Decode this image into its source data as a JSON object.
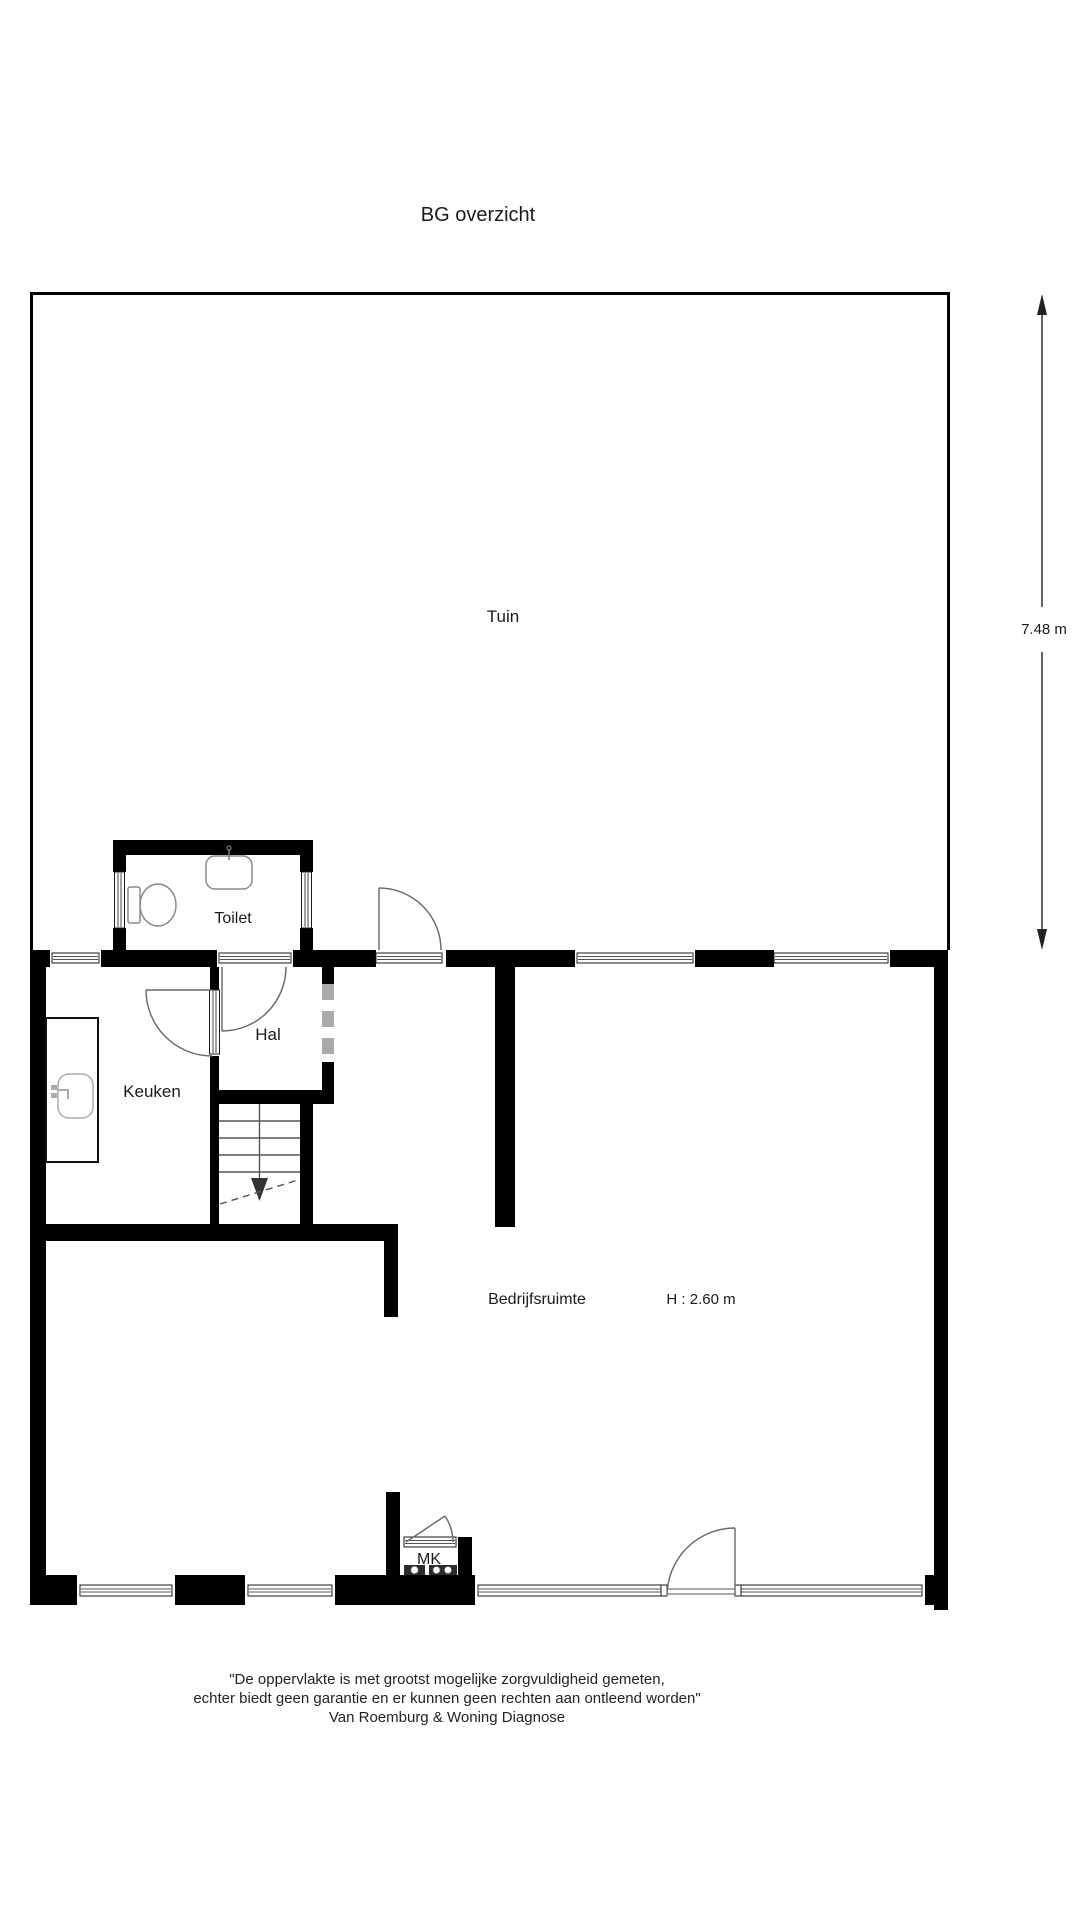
{
  "title": "BG overzicht",
  "plan": {
    "rooms": {
      "tuin": "Tuin",
      "toilet": "Toilet",
      "hal": "Hal",
      "keuken": "Keuken",
      "bedrijfsruimte": "Bedrijfsruimte",
      "mk": "MK"
    },
    "dimension": "7.48 m",
    "ceiling_height": "H : 2.60 m"
  },
  "footer": {
    "line1": "\"De oppervlakte is met grootst mogelijke zorgvuldigheid gemeten,",
    "line2": "echter biedt geen garantie en er kunnen geen rechten aan ontleend worden\"",
    "line3": "Van Roemburg & Woning Diagnose"
  },
  "colors": {
    "wall": "#000000",
    "background": "#ffffff",
    "door_line": "#666666",
    "stair_line": "#555555",
    "fixture_line": "#999999",
    "open_passage_dash": "#aaaaaa"
  }
}
